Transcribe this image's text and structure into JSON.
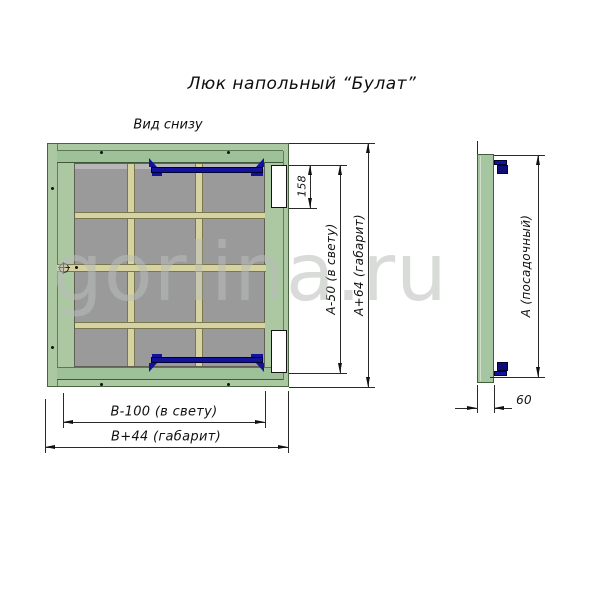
{
  "title": "Люк напольный “Булат”",
  "view_label": "Вид снизу",
  "watermark": "gorlina.ru",
  "dims": {
    "d158": "158",
    "a_clear": "А-50 (в свету)",
    "a_overall": "А+64 (габарит)",
    "b_clear": "В-100 (в свету)",
    "b_overall": "В+44 (габарит)",
    "a_seat": "А (посадочный)",
    "d60": "60"
  },
  "icons": {
    "center_mark": "crosshair-center-mark"
  },
  "colors": {
    "frame_green": "#abc8a3",
    "lid_green": "#9fc199",
    "panel_gray": "#9a9a9b",
    "rib_beige": "#d7d2a2",
    "latch_navy": "#12129b",
    "hinge_white": "#ffffff",
    "line": "#2a2a2a",
    "watermark_gray": "#bec2be"
  }
}
